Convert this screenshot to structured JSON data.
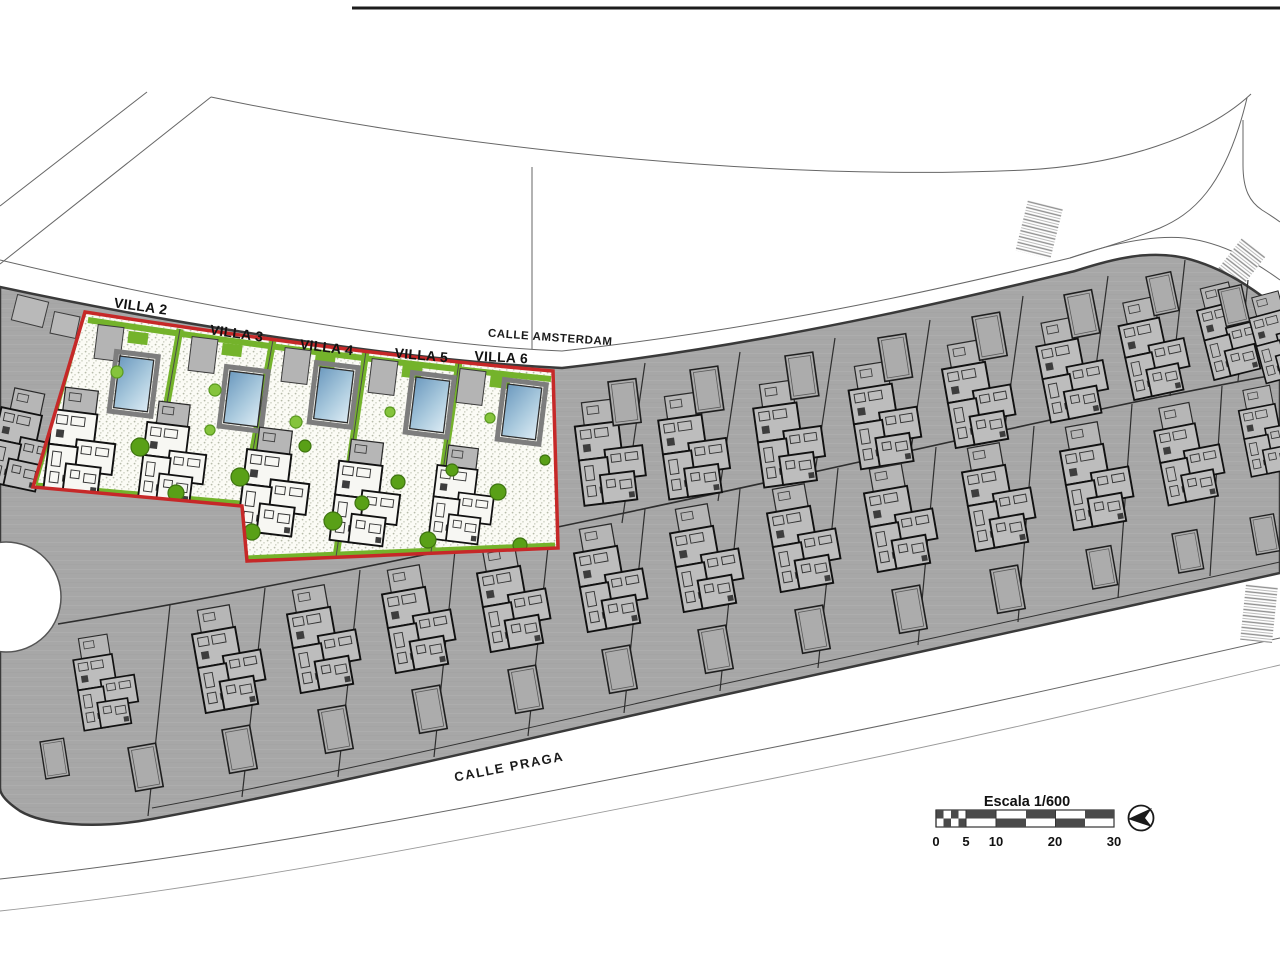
{
  "plan": {
    "highlighted_villas": [
      {
        "label": "VILLA 2"
      },
      {
        "label": "VILLA 3"
      },
      {
        "label": "VILLA 4"
      },
      {
        "label": "VILLA 5"
      },
      {
        "label": "VILLA 6"
      }
    ],
    "streets": {
      "north": "CALLE AMSTERDAM",
      "south": "CALLE PRAGA"
    },
    "scale_bar": {
      "title": "Escala 1/600",
      "ticks": [
        "0",
        "5",
        "10",
        "20",
        "30"
      ]
    },
    "icons": {
      "compass": "north-arrow-compass-icon"
    },
    "colors": {
      "highlight_border": "#c62828",
      "landscape_green": "#74b32b",
      "pool_blue": "#7ba3c4",
      "plot_gray": "#a7a7a7"
    }
  }
}
